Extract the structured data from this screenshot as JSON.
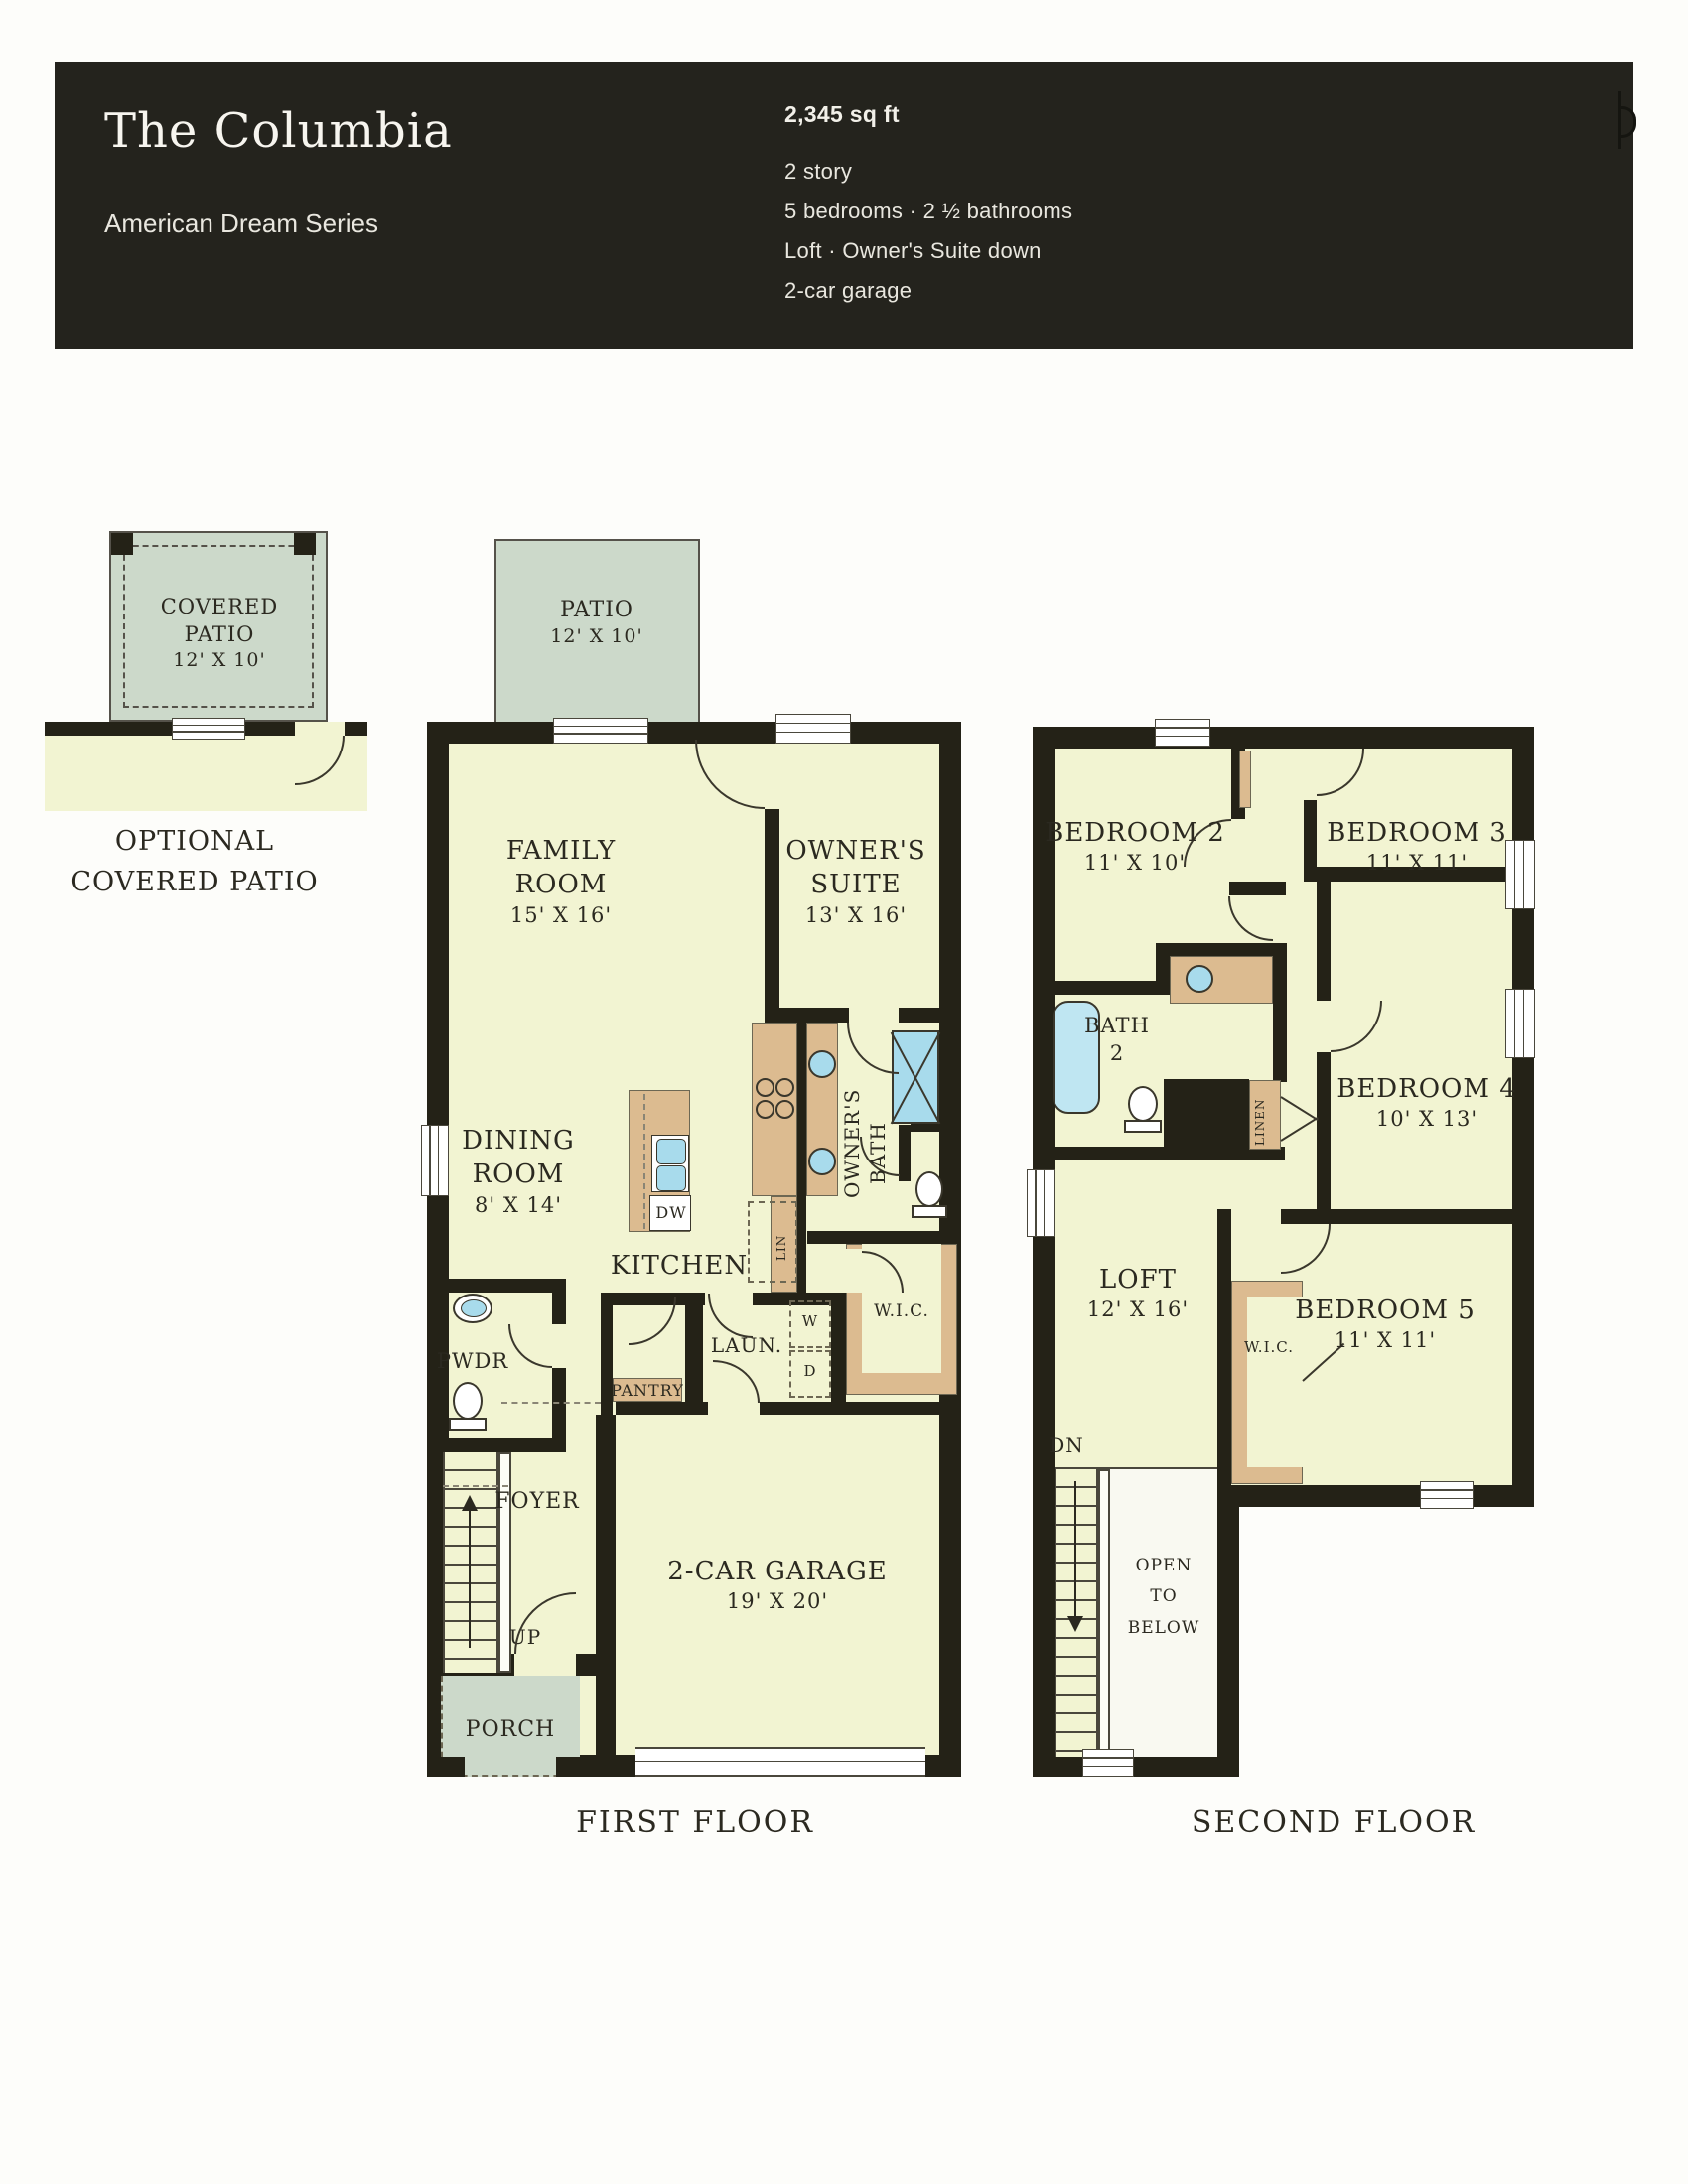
{
  "header": {
    "title": "The Columbia",
    "series": "American Dream Series",
    "sqft": "2,345 sq ft",
    "spec_story": "2 story",
    "spec_beds": "5 bedrooms · 2 ½ bathrooms",
    "spec_loft": "Loft · Owner's Suite down",
    "spec_garage": "2-car garage"
  },
  "inset": {
    "patio_line1": "COVERED",
    "patio_line2": "PATIO",
    "patio_dims": "12' X 10'",
    "caption_line1": "OPTIONAL",
    "caption_line2": "COVERED PATIO"
  },
  "first_floor": {
    "caption": "FIRST FLOOR",
    "patio_name": "PATIO",
    "patio_dims": "12' X 10'",
    "family_line1": "FAMILY",
    "family_line2": "ROOM",
    "family_dims": "15' X 16'",
    "owners_line1": "OWNER'S",
    "owners_line2": "SUITE",
    "owners_dims": "13' X 16'",
    "dining_line1": "DINING",
    "dining_line2": "ROOM",
    "dining_dims": "8' X 14'",
    "kitchen": "KITCHEN",
    "bath_line1": "OWNER'S",
    "bath_line2": "BATH",
    "wic": "W.I.C.",
    "lin": "LIN",
    "dw": "DW",
    "pwdr": "PWDR",
    "laun": "LAUN.",
    "washer": "W",
    "dryer": "D",
    "pantry": "PANTRY",
    "foyer": "FOYER",
    "up": "UP",
    "porch": "PORCH",
    "garage_name": "2-CAR GARAGE",
    "garage_dims": "19' X 20'"
  },
  "second_floor": {
    "caption": "SECOND FLOOR",
    "bed2_name": "BEDROOM 2",
    "bed2_dims": "11' X 10'",
    "bed3_name": "BEDROOM 3",
    "bed3_dims": "11' X 11'",
    "bed4_name": "BEDROOM 4",
    "bed4_dims": "10' X 13'",
    "bed5_name": "BEDROOM 5",
    "bed5_dims": "11' X 11'",
    "bath2_line1": "BATH",
    "bath2_line2": "2",
    "loft_name": "LOFT",
    "loft_dims": "12' X 16'",
    "wic": "W.I.C.",
    "linen": "LINEN",
    "dn": "DN",
    "open_line1": "OPEN",
    "open_line2": "TO",
    "open_line3": "BELOW"
  },
  "colors": {
    "header_bg": "#24231d",
    "wall": "#242217",
    "room_fill": "#f2f4d2",
    "patio_sage": "#ccd9ca",
    "cabinet_tan": "#dcbb90",
    "fixture_blue": "#a8dbec"
  }
}
